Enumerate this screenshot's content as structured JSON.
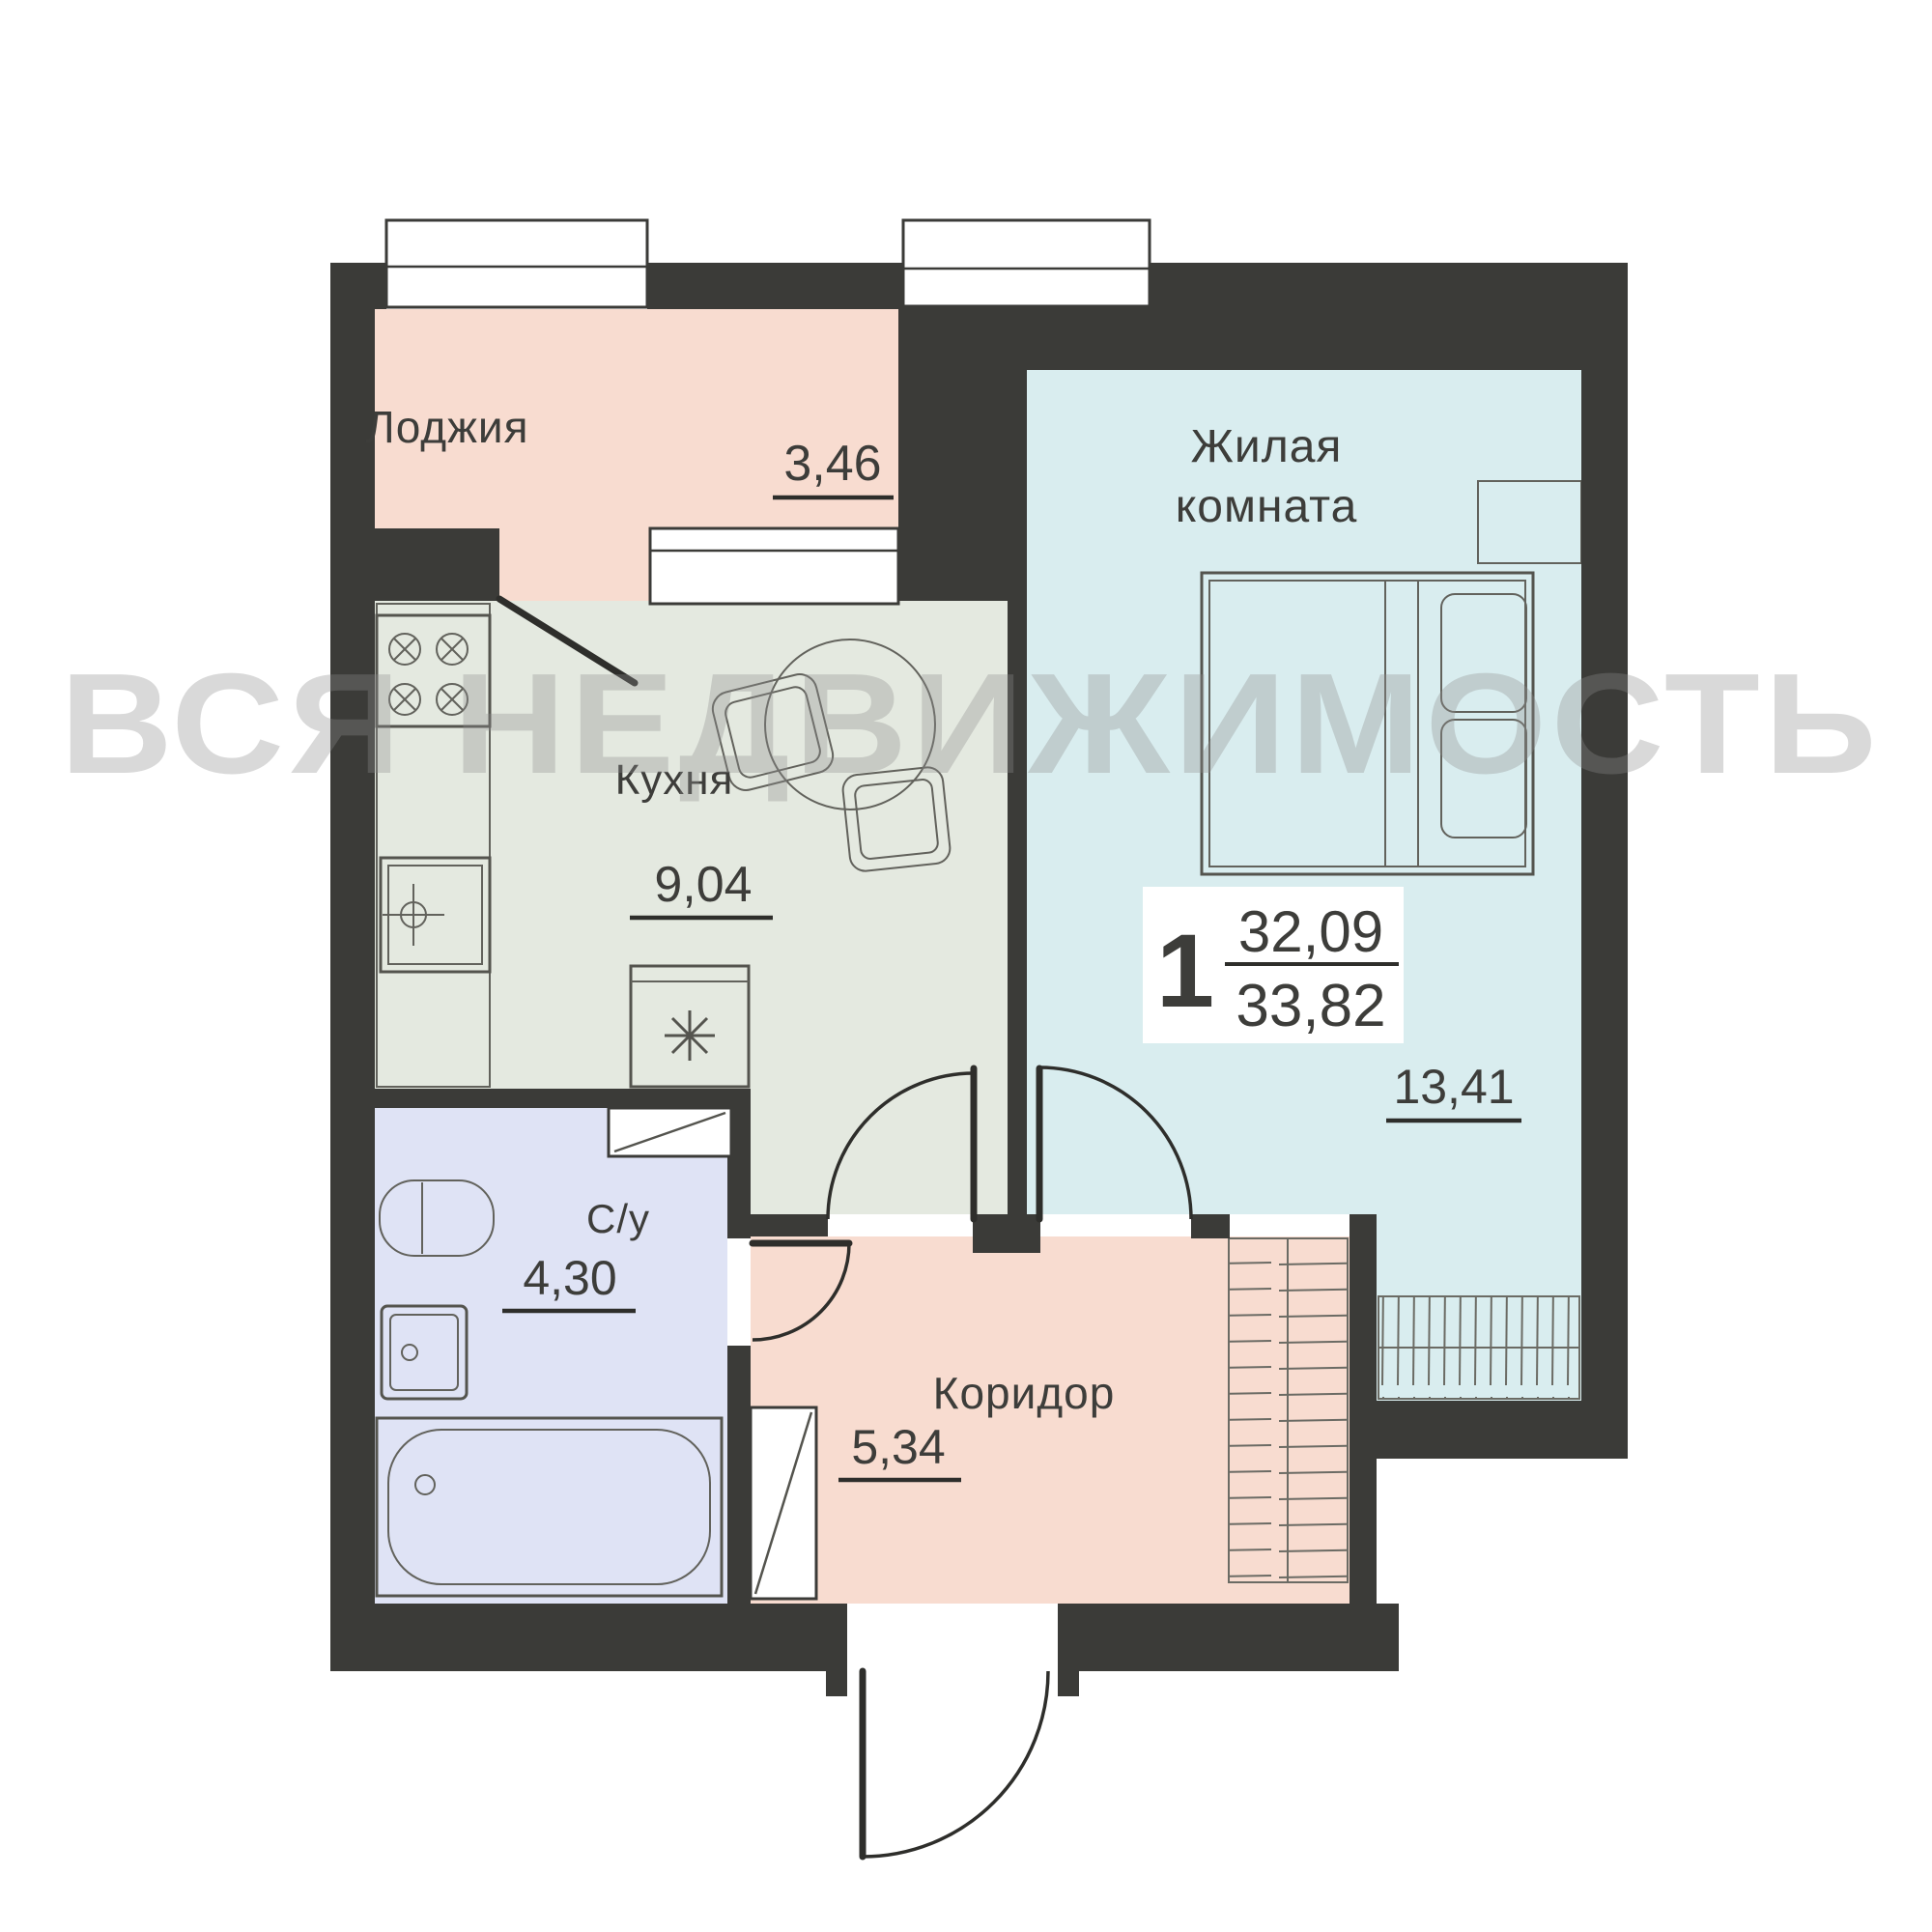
{
  "watermark": "ВСЯ НЕДВИЖИМОСТЬ",
  "summary": {
    "rooms_count": "1",
    "living_area": "32,09",
    "total_area": "33,82"
  },
  "rooms": {
    "loggia": {
      "name": "Лоджия",
      "area": "3,46"
    },
    "kitchen": {
      "name": "Кухня",
      "area": "9,04"
    },
    "living_room": {
      "name_line1": "Жилая",
      "name_line2": "комната",
      "area": "13,41"
    },
    "bathroom": {
      "name": "С/у",
      "area": "4,30"
    },
    "corridor": {
      "name": "Коридор",
      "area": "5,34"
    }
  },
  "colors": {
    "wall": "#3b3b38",
    "loggia": "#f8dcd0",
    "kitchen": "#e4e9e0",
    "living_room": "#d9edef",
    "bathroom": "#dfe3f5",
    "corridor": "#f8dcd0",
    "watermark": "#8e8e8e"
  }
}
